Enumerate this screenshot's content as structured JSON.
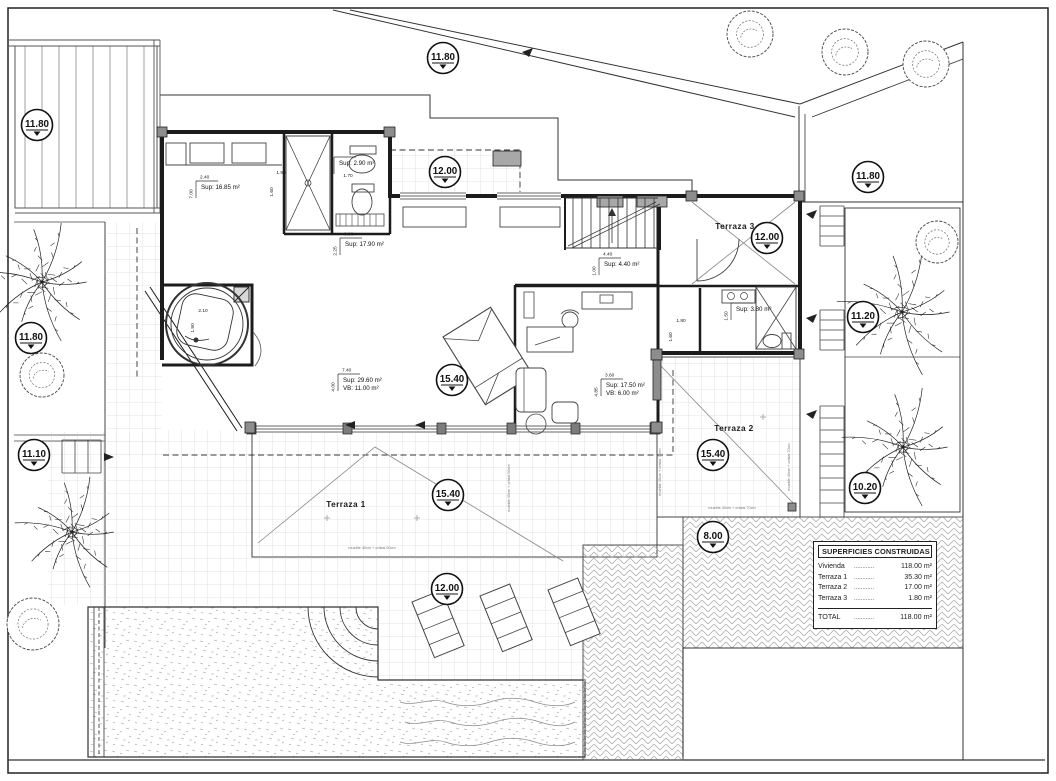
{
  "drawing": {
    "table": {
      "title": "SUPERFICIES CONSTRUIDAS",
      "leader_dots": "............",
      "rows": [
        {
          "label": "Vivienda",
          "value": "118.00 m²"
        },
        {
          "label": "Terraza 1",
          "value": "35.30 m²"
        },
        {
          "label": "Terraza 2",
          "value": "17.00 m²"
        },
        {
          "label": "Terraza 3",
          "value": "1.80 m²"
        }
      ],
      "total": {
        "label": "TOTAL",
        "value": "118.00 m²"
      }
    },
    "elevation_markers": [
      {
        "label": "11.80",
        "x": 37,
        "y": 125
      },
      {
        "label": "11.80",
        "x": 443,
        "y": 58
      },
      {
        "label": "12.00",
        "x": 445,
        "y": 172
      },
      {
        "label": "11.80",
        "x": 868,
        "y": 177
      },
      {
        "label": "12.00",
        "x": 767,
        "y": 238
      },
      {
        "label": "11.20",
        "x": 863,
        "y": 317
      },
      {
        "label": "11.80",
        "x": 31,
        "y": 338
      },
      {
        "label": "15.40",
        "x": 452,
        "y": 380
      },
      {
        "label": "11.10",
        "x": 34,
        "y": 455
      },
      {
        "label": "15.40",
        "x": 713,
        "y": 455
      },
      {
        "label": "10.20",
        "x": 865,
        "y": 488
      },
      {
        "label": "15.40",
        "x": 448,
        "y": 495
      },
      {
        "label": "8.00",
        "x": 713,
        "y": 537
      },
      {
        "label": "12.00",
        "x": 447,
        "y": 589
      }
    ],
    "terraces": [
      {
        "name": "Terraza 1",
        "x": 346,
        "y": 507
      },
      {
        "name": "Terraza 2",
        "x": 734,
        "y": 431
      },
      {
        "name": "Terraza 3",
        "x": 735,
        "y": 229
      }
    ],
    "rooms": [
      {
        "lines": [
          "Sup: 16.85 m²"
        ],
        "dim_top": "2.40",
        "dim_side": "7.00",
        "x": 196,
        "y": 186
      },
      {
        "lines": [
          "Sup: 2.90 m²"
        ],
        "dim_top": "",
        "dim_side": "",
        "x": 334,
        "y": 162
      },
      {
        "lines": [
          "Sup: 17.90 m²"
        ],
        "dim_top": "8.00",
        "dim_side": "2.25",
        "x": 340,
        "y": 243
      },
      {
        "lines": [
          "Sup: 4.40 m²"
        ],
        "dim_top": "4.40",
        "dim_side": "1.00",
        "x": 599,
        "y": 263
      },
      {
        "lines": [
          "Sup: 29.60 m²",
          "VB: 11.00 m²"
        ],
        "dim_top": "7.40",
        "dim_side": "4.00",
        "x": 338,
        "y": 379
      },
      {
        "lines": [
          "Sup: 17.50 m²",
          "VB: 6.00 m²"
        ],
        "dim_top": "3.60",
        "dim_side": "4.85",
        "x": 601,
        "y": 384
      },
      {
        "lines": [
          "Sup: 3.80 m²"
        ],
        "dim_top": "",
        "dim_side": "1.50",
        "x": 731,
        "y": 308
      }
    ],
    "dims": [
      {
        "text": "1.70",
        "x": 348,
        "y": 177,
        "rot": 0
      },
      {
        "text": "1.90",
        "x": 281,
        "y": 174,
        "rot": 0
      },
      {
        "text": "1.60",
        "x": 273,
        "y": 192,
        "rot": -90
      },
      {
        "text": "1.80",
        "x": 681,
        "y": 322,
        "rot": 0
      },
      {
        "text": "1.60",
        "x": 672,
        "y": 337,
        "rot": -90
      },
      {
        "text": "2.10",
        "x": 203,
        "y": 312,
        "rot": 0
      },
      {
        "text": "1.90",
        "x": 194,
        "y": 328,
        "rot": -90
      }
    ],
    "notes": [
      {
        "text": "mueble 40cm + cristal 50cm",
        "x": 372,
        "y": 549,
        "rot": 0
      },
      {
        "text": "mueble 40cm + cristal 50cm",
        "x": 510,
        "y": 488,
        "rot": -90
      },
      {
        "text": "mueble 40cm + cristal 70cm",
        "x": 661,
        "y": 472,
        "rot": -90
      },
      {
        "text": "mueble 40cm + cristal 70cm",
        "x": 790,
        "y": 467,
        "rot": -90
      },
      {
        "text": "mueble 40cm + cristal 70cm",
        "x": 732,
        "y": 509,
        "rot": 0
      }
    ],
    "trees": {
      "palms": [
        {
          "x": 42,
          "y": 282,
          "r": 62
        },
        {
          "x": 72,
          "y": 532,
          "r": 58
        },
        {
          "x": 902,
          "y": 312,
          "r": 66
        },
        {
          "x": 903,
          "y": 447,
          "r": 62
        }
      ],
      "bushes": [
        {
          "x": 42,
          "y": 375,
          "r": 22
        },
        {
          "x": 33,
          "y": 624,
          "r": 26
        },
        {
          "x": 937,
          "y": 242,
          "r": 21
        },
        {
          "x": 750,
          "y": 34,
          "r": 23
        },
        {
          "x": 845,
          "y": 52,
          "r": 23
        },
        {
          "x": 926,
          "y": 64,
          "r": 23
        }
      ]
    }
  }
}
